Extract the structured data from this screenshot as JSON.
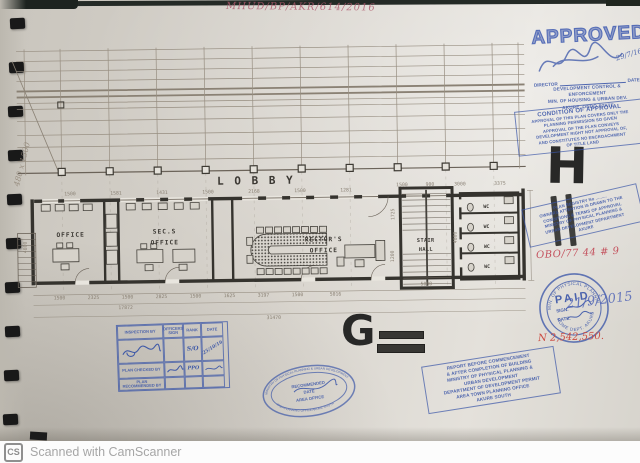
{
  "colors": {
    "stamp_blue": "#3a55a8",
    "ink_red": "#c4525e",
    "marker_black": "#2b2b2b",
    "paper": "#d9d5cd",
    "plan_line": "#8d8477",
    "wall_dark": "#35332e"
  },
  "notes": {
    "reference": "MHUD/BP/AKR/614/2016",
    "margin": "480 x 1500",
    "marker_h": "H",
    "marker_g": "G",
    "red_code": "OBO/77 44 # 9",
    "amount": "N 2,542,550.",
    "paid_handwritten_date": "21/9/2015"
  },
  "scanner_bar": {
    "logo": "CS",
    "text": "Scanned with CamScanner"
  },
  "stamps": {
    "approved": {
      "title": "APPROVED",
      "director_label": "DIRECTOR",
      "date_label": "DATE",
      "signature_date": "29/7/16",
      "line2": "DEVELOPMENT CONTROL & ENFORCEMENT",
      "line3": "MIN. OF HOUSING & URBAN DEV.",
      "line4": "AKURE, ONDO STATE"
    },
    "condition": {
      "title": "CONDITION OF APPROVAL",
      "lines": [
        "APPROVAL OF THIS PLAN COVERS ONLY THE",
        "PLANNING PERMISSION SO GIVEN",
        "APPROVAL OF THE PLAN CONVEYS",
        "DEVELOPMENT RIGHT NOT APPROVAL OF,",
        "AND CONSTITUTES NO ENCROACHMENT",
        "OF TITLE LAND"
      ]
    },
    "registry": {
      "lines": [
        "PLAN REGISTRY No .........",
        "OWNERS ATTENTION IS DRAWN TO THE",
        "CONDITIONS & TERMS OF APPROVAL",
        "MINISTRY OF PHYSICAL PLANNING &",
        "URBAN DEVELOPMENT DEPARTMENT",
        "AKURE"
      ]
    },
    "paid": {
      "title": "PAID",
      "sign_label": "SIGN.",
      "date_label": "DATE.",
      "ring_top": "MIN. OF PHYSICAL PLANNING & URBAN DEV.",
      "ring_bottom": "HOME DEPT. AKURE"
    },
    "report": {
      "lines": [
        "REPORT BEFORE COMMENCEMENT",
        "& AFTER COMPLETION OF BUILDING",
        "MINISTRY OF PHYSICAL PLANNING &",
        "URBAN DEVELOPMENT",
        "DEPARTMENT OF DEVELOPMENT PERMIT",
        "AREA TOWN PLANNING OFFICE",
        "AKURE SOUTH"
      ]
    },
    "oval": {
      "ring_top": "MINISTRY OF PHYSICAL PLANNING & URBAN DEVELOPMENT",
      "ring_bottom": "AREA PLANNING OFFICE AKURE SOUTH",
      "center": [
        "RECOMMENDED",
        "DATE",
        "AREA OFFICE"
      ]
    },
    "inspection": {
      "headers": [
        "INSPECTION BY",
        "OFFICERS SIGN",
        "RANK",
        "DATE"
      ],
      "row1_rank": "S/O",
      "row1_date": "25/10/16",
      "row2_label": "PLAN CHECKED BY",
      "row2_rank": "PPO",
      "row3_label": "PLAN RECOMMENDED BY"
    }
  },
  "plan": {
    "lobby_label": "L O B B Y",
    "rooms": {
      "office": "OFFICE",
      "sec1": "SEC.S",
      "sec2": "OFFICE",
      "rector1": "RECTOR'S",
      "rector2": "OFFICE",
      "stair1": "STAIR",
      "stair2": "HALL",
      "wc": "WC"
    },
    "dims_top": [
      "1500",
      "1581",
      "1431",
      "1500",
      "2168",
      "1500",
      "1281"
    ],
    "dims_top_right": [
      "1500",
      "900",
      "3000",
      "3375"
    ],
    "dims_bottom": [
      "1500",
      "2325",
      "1500",
      "2825",
      "1500",
      "1625",
      "3197",
      "1500",
      "5016"
    ],
    "dims_totals": [
      "17872",
      "31470"
    ],
    "dims_side": [
      "4800",
      "1725",
      "5000",
      "1200",
      "4800"
    ]
  }
}
